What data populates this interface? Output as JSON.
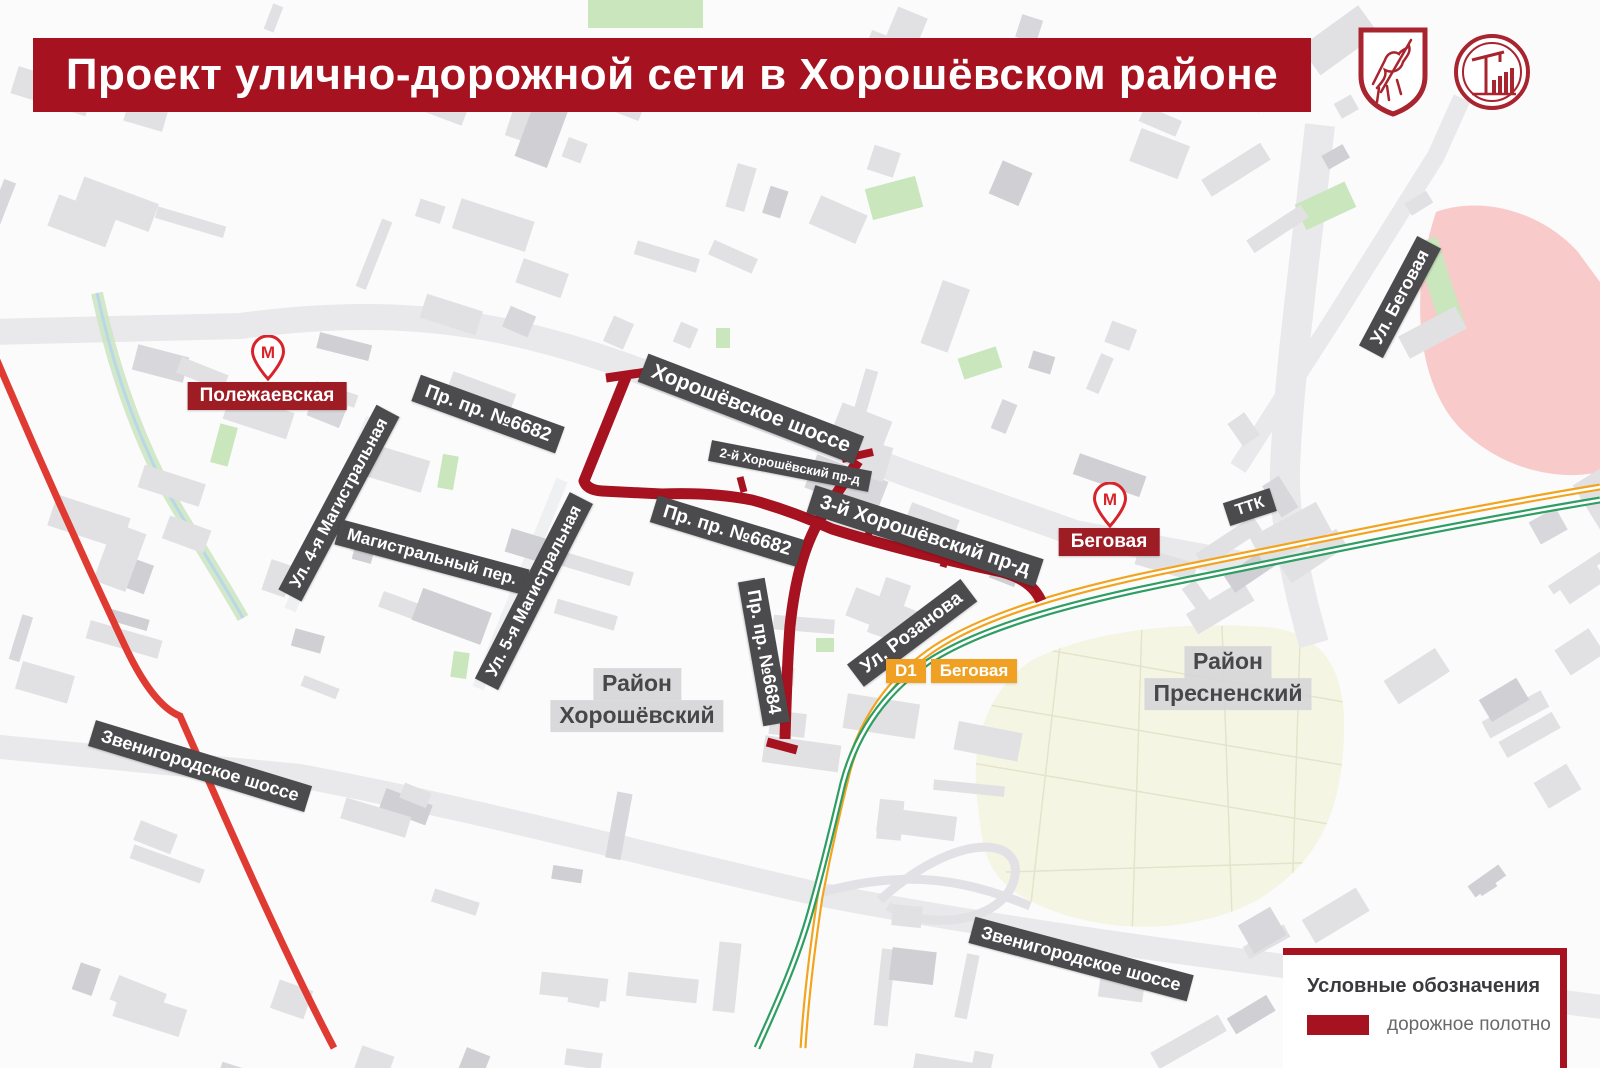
{
  "banner": {
    "title": "Проект улично-дорожной сети в Хорошёвском районе",
    "bg_color": "#a6121f",
    "logos": [
      {
        "name": "moscow-coat-of-arms"
      },
      {
        "name": "moscow-construction-complex-logo"
      }
    ]
  },
  "colors": {
    "project_road": "#a6121f",
    "highway_red_line": "#df3b32",
    "d1_orange": "#f0a124",
    "d1_green": "#2f9e63",
    "street_chip_bg": "#4b4b4e",
    "metro_red": "#d8232a",
    "metro_chip_bg": "#9e1c23",
    "district_chip_bg": "#d9d9db",
    "map_bg": "#fbfbfc",
    "building": "#e1e1e4",
    "cemetery_area": "#f5f5e4",
    "hippodrome_area": "#f8cbca"
  },
  "metro_stations": [
    {
      "name": "Полежаевская",
      "pin_x": 268,
      "pin_y": 357,
      "label_x": 267,
      "label_y": 396
    },
    {
      "name": "Беговая",
      "pin_x": 1110,
      "pin_y": 504,
      "label_x": 1109,
      "label_y": 542
    }
  ],
  "d1_station": {
    "line_badge": "D1",
    "name": "Беговая",
    "x": 886,
    "y": 659
  },
  "street_labels": [
    {
      "text": "Пр. пр. №6682",
      "x": 488,
      "y": 414,
      "rot": 20,
      "fs": 19
    },
    {
      "text": "Хорошёвское шоссе",
      "x": 751,
      "y": 409,
      "rot": 21,
      "fs": 21
    },
    {
      "text": "2-й Хорошёвский пр-д",
      "x": 790,
      "y": 466,
      "rot": 11,
      "fs": 13
    },
    {
      "text": "Пр. пр. №6682",
      "x": 727,
      "y": 531,
      "rot": 17,
      "fs": 19
    },
    {
      "text": "3-й Хорошёвский пр-д",
      "x": 925,
      "y": 536,
      "rot": 18,
      "fs": 20
    },
    {
      "text": "Пр. пр. №6684",
      "x": 764,
      "y": 652,
      "rot": 80,
      "fs": 18
    },
    {
      "text": "Ул. Розанова",
      "x": 912,
      "y": 633,
      "rot": -37,
      "fs": 19
    },
    {
      "text": "Ул. 4-я Магистральная",
      "x": 339,
      "y": 503,
      "rot": -62,
      "fs": 17
    },
    {
      "text": "Магистральный пер.",
      "x": 432,
      "y": 557,
      "rot": 15,
      "fs": 17
    },
    {
      "text": "Ул. 5-я Магистральная",
      "x": 534,
      "y": 591,
      "rot": -63,
      "fs": 17
    },
    {
      "text": "Ул. Беговая",
      "x": 1400,
      "y": 297,
      "rot": -62,
      "fs": 18
    },
    {
      "text": "ТТК",
      "x": 1250,
      "y": 507,
      "rot": -18,
      "fs": 16
    },
    {
      "text": "Звенигородское шоссе",
      "x": 200,
      "y": 766,
      "rot": 17,
      "fs": 18
    },
    {
      "text": "Звенигородское шоссе",
      "x": 1081,
      "y": 959,
      "rot": 15,
      "fs": 18
    }
  ],
  "district_labels": [
    {
      "line1": "Район",
      "line2": "Хорошёвский",
      "x": 637,
      "y": 700
    },
    {
      "line1": "Район",
      "line2": "Пресненский",
      "x": 1228,
      "y": 678
    }
  ],
  "legend": {
    "title": "Условные обозначения",
    "items": [
      {
        "label": "дорожное полотно",
        "color": "#a6121f"
      }
    ]
  }
}
